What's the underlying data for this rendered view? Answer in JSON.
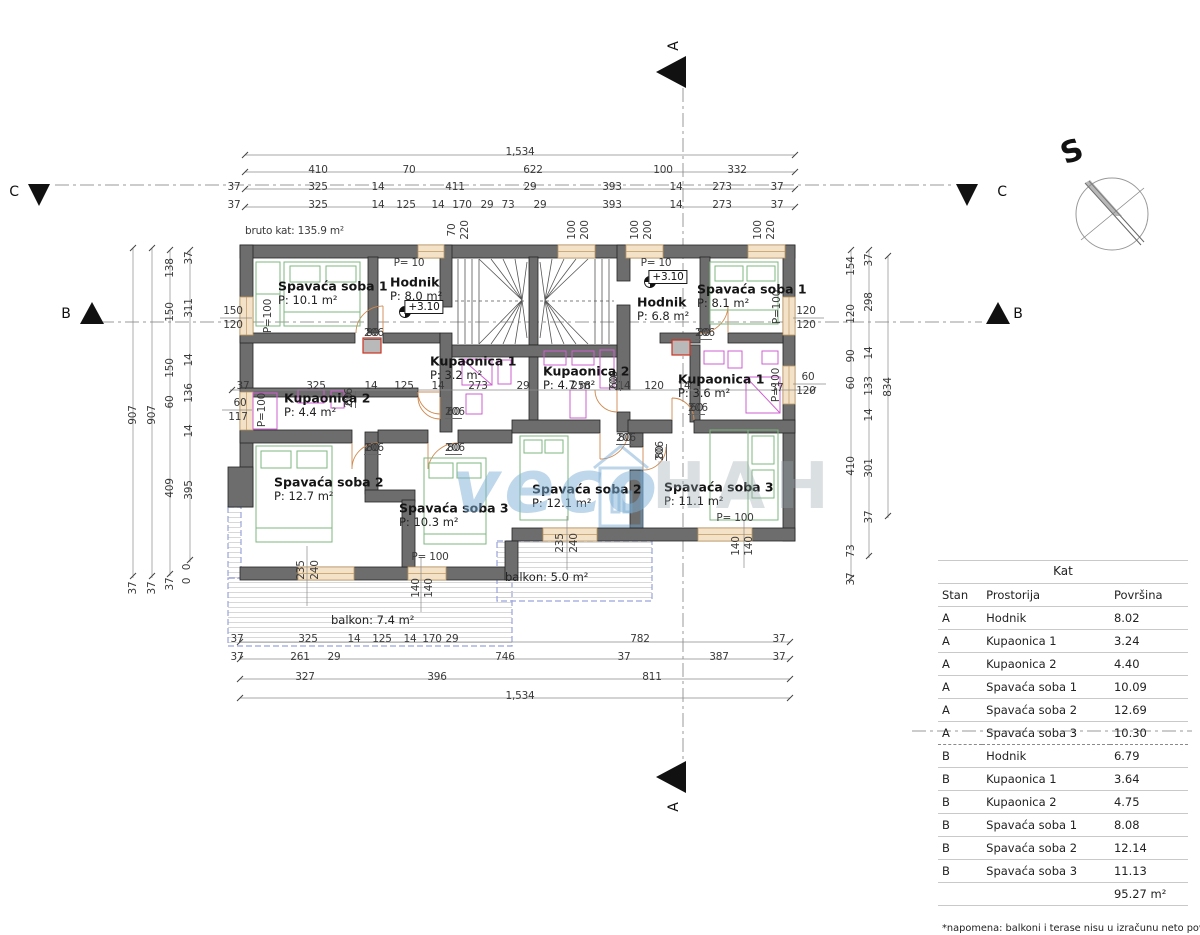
{
  "compass": {
    "label": "S"
  },
  "watermark": {
    "blue": "veco",
    "gray": "HAH"
  },
  "note": "*napomena: balkoni i terase nisu u izračunu neto površina",
  "table": {
    "title": "Kat",
    "headers": [
      "Stan",
      "Prostorija",
      "Površina"
    ],
    "rows": [
      [
        "A",
        "Hodnik",
        "8.02"
      ],
      [
        "A",
        "Kupaonica 1",
        "3.24"
      ],
      [
        "A",
        "Kupaonica 2",
        "4.40"
      ],
      [
        "A",
        "Spavaća soba 1",
        "10.09"
      ],
      [
        "A",
        "Spavaća soba 2",
        "12.69"
      ],
      [
        "A",
        "Spavaća soba 3",
        "10.30"
      ],
      [
        "B",
        "Hodnik",
        "6.79"
      ],
      [
        "B",
        "Kupaonica 1",
        "3.64"
      ],
      [
        "B",
        "Kupaonica 2",
        "4.75"
      ],
      [
        "B",
        "Spavaća soba 1",
        "8.08"
      ],
      [
        "B",
        "Spavaća soba 2",
        "12.14"
      ],
      [
        "B",
        "Spavaća soba 3",
        "11.13"
      ]
    ],
    "total": "95.27 m²"
  },
  "rooms": [
    {
      "n": "Spavaća soba 1",
      "a": "P: 10.1 m²",
      "x": 278,
      "y": 286
    },
    {
      "n": "Hodnik",
      "a": "P: 8.0 m²",
      "x": 390,
      "y": 282
    },
    {
      "n": "Kupaonica 1",
      "a": "P: 3.2 m²",
      "x": 430,
      "y": 361
    },
    {
      "n": "Kupaonica 2",
      "a": "P: 4.4 m²",
      "x": 284,
      "y": 398
    },
    {
      "n": "Spavaća soba 2",
      "a": "P: 12.7 m²",
      "x": 274,
      "y": 482
    },
    {
      "n": "Spavaća soba 3",
      "a": "P: 10.3 m²",
      "x": 399,
      "y": 508
    },
    {
      "n": "Hodnik",
      "a": "P: 6.8 m²",
      "x": 637,
      "y": 302
    },
    {
      "n": "Spavaća soba 1",
      "a": "P: 8.1 m²",
      "x": 697,
      "y": 289
    },
    {
      "n": "Kupaonica 2",
      "a": "P: 4.7 m²",
      "x": 543,
      "y": 371
    },
    {
      "n": "Kupaonica 1",
      "a": "P: 3.6 m²",
      "x": 678,
      "y": 379
    },
    {
      "n": "Spavaća soba 2",
      "a": "P: 12.1 m²",
      "x": 532,
      "y": 489
    },
    {
      "n": "Spavaća soba 3",
      "a": "P: 11.1 m²",
      "x": 664,
      "y": 487
    }
  ],
  "balconies": [
    {
      "t": "balkon: 7.4 m²",
      "x": 331,
      "y": 620
    },
    {
      "t": "balkon: 5.0 m²",
      "x": 505,
      "y": 577
    }
  ],
  "sections": [
    {
      "t": "C",
      "x": 14,
      "y": 192
    },
    {
      "t": "C",
      "x": 1002,
      "y": 192
    },
    {
      "t": "B",
      "x": 66,
      "y": 314
    },
    {
      "t": "B",
      "x": 1018,
      "y": 314
    },
    {
      "t": "A",
      "x": 674,
      "y": 46,
      "r": 1
    },
    {
      "t": "A",
      "x": 674,
      "y": 807,
      "r": 1
    }
  ],
  "fracs": [
    {
      "a": "80",
      "b": "206",
      "x": 364,
      "y": 327
    },
    {
      "a": "60",
      "b": "206",
      "x": 343,
      "y": 408,
      "r": 1
    },
    {
      "a": "80",
      "b": "206",
      "x": 364,
      "y": 442
    },
    {
      "a": "60",
      "b": "206",
      "x": 445,
      "y": 406
    },
    {
      "a": "80",
      "b": "206",
      "x": 445,
      "y": 442
    },
    {
      "a": "60",
      "b": "206",
      "x": 608,
      "y": 391,
      "r": 1
    },
    {
      "a": "80",
      "b": "206",
      "x": 616,
      "y": 432
    },
    {
      "a": "80",
      "b": "206",
      "x": 654,
      "y": 461,
      "r": 1
    },
    {
      "a": "60",
      "b": "206",
      "x": 688,
      "y": 402
    },
    {
      "a": "80",
      "b": "206",
      "x": 695,
      "y": 327
    }
  ],
  "labels": [
    {
      "t": "1,534",
      "x": 520,
      "y": 152
    },
    {
      "t": "410",
      "x": 318,
      "y": 170
    },
    {
      "t": "70",
      "x": 409,
      "y": 170
    },
    {
      "t": "622",
      "x": 533,
      "y": 170
    },
    {
      "t": "100",
      "x": 663,
      "y": 170
    },
    {
      "t": "332",
      "x": 737,
      "y": 170
    },
    {
      "t": "37",
      "x": 234,
      "y": 187
    },
    {
      "t": "325",
      "x": 318,
      "y": 187
    },
    {
      "t": "14",
      "x": 378,
      "y": 187
    },
    {
      "t": "411",
      "x": 455,
      "y": 187
    },
    {
      "t": "29",
      "x": 530,
      "y": 187
    },
    {
      "t": "393",
      "x": 612,
      "y": 187
    },
    {
      "t": "14",
      "x": 676,
      "y": 187
    },
    {
      "t": "273",
      "x": 722,
      "y": 187
    },
    {
      "t": "37",
      "x": 777,
      "y": 187
    },
    {
      "t": "37",
      "x": 234,
      "y": 205
    },
    {
      "t": "325",
      "x": 318,
      "y": 205
    },
    {
      "t": "14",
      "x": 378,
      "y": 205
    },
    {
      "t": "125",
      "x": 406,
      "y": 205
    },
    {
      "t": "14",
      "x": 438,
      "y": 205
    },
    {
      "t": "170",
      "x": 462,
      "y": 205
    },
    {
      "t": "29",
      "x": 487,
      "y": 205
    },
    {
      "t": "73",
      "x": 508,
      "y": 205
    },
    {
      "t": "29",
      "x": 540,
      "y": 205
    },
    {
      "t": "393",
      "x": 612,
      "y": 205
    },
    {
      "t": "14",
      "x": 676,
      "y": 205
    },
    {
      "t": "273",
      "x": 722,
      "y": 205
    },
    {
      "t": "37",
      "x": 777,
      "y": 205
    },
    {
      "t": "70",
      "x": 452,
      "y": 230,
      "r": 1
    },
    {
      "t": "220",
      "x": 465,
      "y": 230,
      "r": 1
    },
    {
      "t": "100",
      "x": 572,
      "y": 230,
      "r": 1
    },
    {
      "t": "200",
      "x": 585,
      "y": 230,
      "r": 1
    },
    {
      "t": "100",
      "x": 635,
      "y": 230,
      "r": 1
    },
    {
      "t": "200",
      "x": 648,
      "y": 230,
      "r": 1
    },
    {
      "t": "100",
      "x": 758,
      "y": 230,
      "r": 1
    },
    {
      "t": "220",
      "x": 771,
      "y": 230,
      "r": 1
    },
    {
      "t": "bruto kat: 135.9 m²",
      "x": 245,
      "y": 231,
      "c": "left"
    },
    {
      "t": "37",
      "x": 237,
      "y": 639
    },
    {
      "t": "325",
      "x": 308,
      "y": 639
    },
    {
      "t": "14",
      "x": 354,
      "y": 639
    },
    {
      "t": "125",
      "x": 382,
      "y": 639
    },
    {
      "t": "14",
      "x": 410,
      "y": 639
    },
    {
      "t": "170",
      "x": 432,
      "y": 639
    },
    {
      "t": "29",
      "x": 452,
      "y": 639
    },
    {
      "t": "782",
      "x": 640,
      "y": 639
    },
    {
      "t": "37",
      "x": 779,
      "y": 639
    },
    {
      "t": "37",
      "x": 237,
      "y": 657
    },
    {
      "t": "261",
      "x": 300,
      "y": 657
    },
    {
      "t": "29",
      "x": 334,
      "y": 657
    },
    {
      "t": "746",
      "x": 505,
      "y": 657
    },
    {
      "t": "37",
      "x": 624,
      "y": 657
    },
    {
      "t": "387",
      "x": 719,
      "y": 657
    },
    {
      "t": "37",
      "x": 779,
      "y": 657
    },
    {
      "t": "327",
      "x": 305,
      "y": 677
    },
    {
      "t": "396",
      "x": 437,
      "y": 677
    },
    {
      "t": "811",
      "x": 652,
      "y": 677
    },
    {
      "t": "1,534",
      "x": 520,
      "y": 696
    },
    {
      "t": "907",
      "x": 133,
      "y": 415,
      "r": 1
    },
    {
      "t": "907",
      "x": 152,
      "y": 415,
      "r": 1
    },
    {
      "t": "138",
      "x": 170,
      "y": 268,
      "r": 1
    },
    {
      "t": "150",
      "x": 170,
      "y": 312,
      "r": 1
    },
    {
      "t": "150",
      "x": 170,
      "y": 368,
      "r": 1
    },
    {
      "t": "60",
      "x": 170,
      "y": 402,
      "r": 1
    },
    {
      "t": "409",
      "x": 170,
      "y": 488,
      "r": 1
    },
    {
      "t": "37",
      "x": 189,
      "y": 258,
      "r": 1
    },
    {
      "t": "311",
      "x": 189,
      "y": 308,
      "r": 1
    },
    {
      "t": "14",
      "x": 189,
      "y": 360,
      "r": 1
    },
    {
      "t": "136",
      "x": 189,
      "y": 393,
      "r": 1
    },
    {
      "t": "14",
      "x": 189,
      "y": 431,
      "r": 1
    },
    {
      "t": "395",
      "x": 189,
      "y": 490,
      "r": 1
    },
    {
      "t": "37",
      "x": 133,
      "y": 588,
      "r": 1
    },
    {
      "t": "37",
      "x": 152,
      "y": 588,
      "r": 1
    },
    {
      "t": "37",
      "x": 170,
      "y": 584,
      "r": 1
    },
    {
      "t": "0",
      "x": 187,
      "y": 567,
      "r": 1
    },
    {
      "t": "0",
      "x": 187,
      "y": 581,
      "r": 1
    },
    {
      "t": "154",
      "x": 851,
      "y": 266,
      "r": 1
    },
    {
      "t": "120",
      "x": 851,
      "y": 314,
      "r": 1
    },
    {
      "t": "90",
      "x": 851,
      "y": 356,
      "r": 1
    },
    {
      "t": "60",
      "x": 851,
      "y": 383,
      "r": 1
    },
    {
      "t": "410",
      "x": 851,
      "y": 466,
      "r": 1
    },
    {
      "t": "73",
      "x": 851,
      "y": 551,
      "r": 1
    },
    {
      "t": "37",
      "x": 851,
      "y": 579,
      "r": 1
    },
    {
      "t": "37",
      "x": 869,
      "y": 260,
      "r": 1
    },
    {
      "t": "298",
      "x": 869,
      "y": 302,
      "r": 1
    },
    {
      "t": "14",
      "x": 869,
      "y": 353,
      "r": 1
    },
    {
      "t": "133",
      "x": 869,
      "y": 386,
      "r": 1
    },
    {
      "t": "14",
      "x": 869,
      "y": 415,
      "r": 1
    },
    {
      "t": "301",
      "x": 869,
      "y": 468,
      "r": 1
    },
    {
      "t": "37",
      "x": 869,
      "y": 517,
      "r": 1
    },
    {
      "t": "834",
      "x": 888,
      "y": 387,
      "r": 1
    },
    {
      "t": "37",
      "x": 243,
      "y": 386
    },
    {
      "t": "325",
      "x": 316,
      "y": 386
    },
    {
      "t": "14",
      "x": 371,
      "y": 386
    },
    {
      "t": "125",
      "x": 404,
      "y": 386
    },
    {
      "t": "14",
      "x": 438,
      "y": 386
    },
    {
      "t": "273",
      "x": 478,
      "y": 386
    },
    {
      "t": "29",
      "x": 523,
      "y": 386
    },
    {
      "t": "258",
      "x": 581,
      "y": 386
    },
    {
      "t": "14",
      "x": 624,
      "y": 386
    },
    {
      "t": "120",
      "x": 654,
      "y": 386
    },
    {
      "t": "14",
      "x": 684,
      "y": 386
    },
    {
      "t": "37",
      "x": 777,
      "y": 388
    },
    {
      "t": "150",
      "x": 233,
      "y": 311
    },
    {
      "t": "120",
      "x": 233,
      "y": 325
    },
    {
      "t": "60",
      "x": 240,
      "y": 403
    },
    {
      "t": "117",
      "x": 238,
      "y": 417
    },
    {
      "t": "120",
      "x": 806,
      "y": 311
    },
    {
      "t": "120",
      "x": 806,
      "y": 325
    },
    {
      "t": "60",
      "x": 808,
      "y": 377
    },
    {
      "t": "120",
      "x": 806,
      "y": 391
    },
    {
      "t": "P= 10",
      "x": 409,
      "y": 263
    },
    {
      "t": "P= 10",
      "x": 656,
      "y": 263
    },
    {
      "t": "P=100",
      "x": 268,
      "y": 316,
      "r": 1
    },
    {
      "t": "P=100",
      "x": 262,
      "y": 410,
      "r": 1
    },
    {
      "t": "P=100",
      "x": 777,
      "y": 307,
      "r": 1
    },
    {
      "t": "P=100",
      "x": 776,
      "y": 385,
      "r": 1
    },
    {
      "t": "P= 100",
      "x": 430,
      "y": 557
    },
    {
      "t": "P= 100",
      "x": 735,
      "y": 518
    },
    {
      "t": "+3.10",
      "x": 424,
      "y": 307,
      "c": "level"
    },
    {
      "t": "+3.10",
      "x": 668,
      "y": 277,
      "c": "level"
    },
    {
      "t": "140",
      "x": 416,
      "y": 588,
      "r": 1
    },
    {
      "t": "140",
      "x": 429,
      "y": 588,
      "r": 1
    },
    {
      "t": "140",
      "x": 736,
      "y": 546,
      "r": 1
    },
    {
      "t": "140",
      "x": 749,
      "y": 546,
      "r": 1
    },
    {
      "t": "235",
      "x": 301,
      "y": 570,
      "r": 1
    },
    {
      "t": "240",
      "x": 315,
      "y": 570,
      "r": 1
    },
    {
      "t": "235",
      "x": 560,
      "y": 543,
      "r": 1
    },
    {
      "t": "240",
      "x": 574,
      "y": 543,
      "r": 1
    }
  ]
}
